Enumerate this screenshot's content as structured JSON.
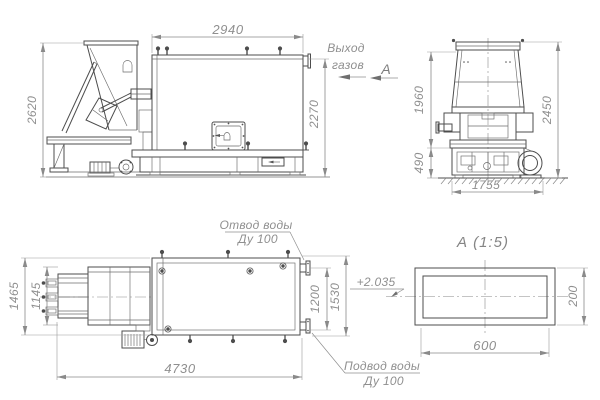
{
  "labels": {
    "gas_outlet_word1": "Выход",
    "gas_outlet_word2": "газов",
    "section_letter": "А",
    "detail_title": "А  (1:5)",
    "water_outlet_name": "Отвод воды",
    "water_outlet_dn": "Ду 100",
    "water_supply_name": "Подвод воды",
    "water_supply_dn": "Ду 100",
    "level_mark": "+2.035"
  },
  "dimensions": {
    "side": {
      "height_overall": "2620",
      "length_body": "2940",
      "height_gas_outlet": "2270"
    },
    "front": {
      "height_hopper_top": "1960",
      "height_overall": "2450",
      "height_base": "490",
      "width_overall": "1755"
    },
    "plan": {
      "width_overall": "1465",
      "width_feeder": "1145",
      "length_overall": "4730",
      "flange_spacing": "1200",
      "body_width": "1530"
    },
    "detail": {
      "duct_width": "600",
      "duct_height": "200"
    }
  },
  "colors": {
    "background": "#ffffff",
    "main_line": "#4d4d4d",
    "thin_line": "#6b6b6b",
    "dimension_line": "#8a8a8a",
    "annotation_text": "#8f8f8f"
  }
}
